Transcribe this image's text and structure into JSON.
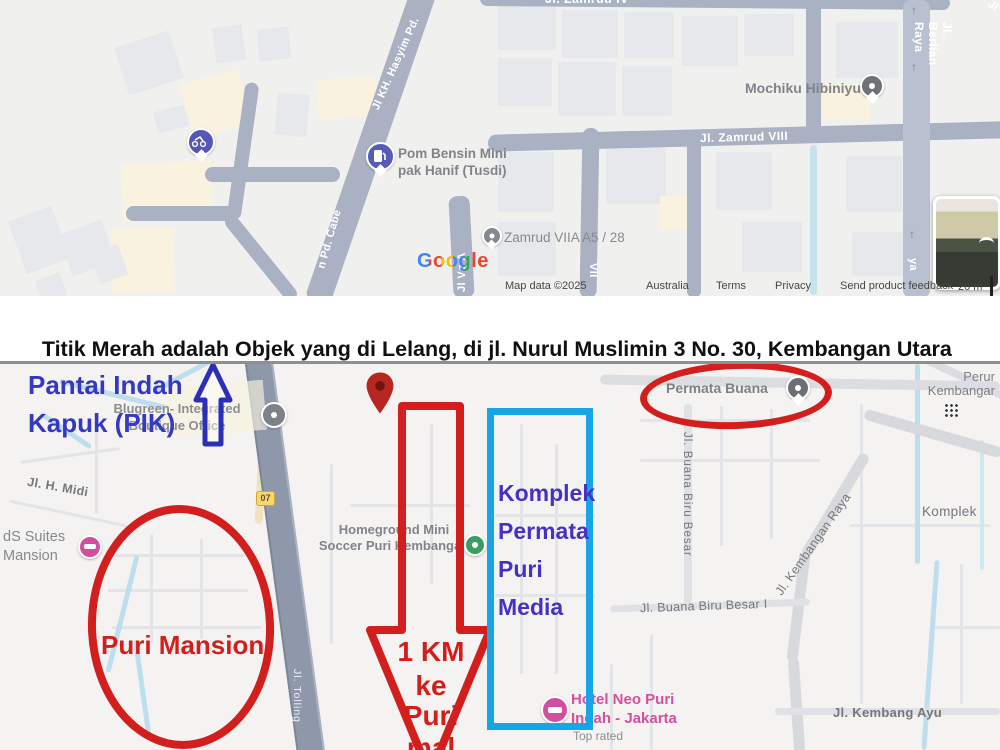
{
  "annotation_title": {
    "part1": "Titik",
    "part2": " Merah ",
    "part3": "adalah Objek",
    "part4": " yang di Lelang, di ",
    "part5": "jl.",
    "part6": " Nurul Muslimin 3 No. 30, Kembangan Utara"
  },
  "top_map": {
    "streets": {
      "hasyim": "Jl KH. Hasyim Pd.",
      "pd_cabe": "n Pd. Cabe",
      "zamrud_viii": "Jl. Zamrud VIII",
      "zamrud_top": "Jl. Zamrud IV",
      "berlian_raya": "Jl. Berlian Raya",
      "vg_a": "Jl Vg A",
      "vii": "VII",
      "ya": "ya",
      "jl_corner": "Jl"
    },
    "pois": {
      "pom_bensin": "Pom Bensin Mini\npak Hanif (Tusdi)",
      "mochiku": "Mochiku Hibiniyu",
      "zamrud_viia": "Zamrud VIIA A5 / 28"
    },
    "google_logo": "Google",
    "attribution": {
      "map_data": "Map data ©2025",
      "region": "Australia",
      "terms": "Terms",
      "privacy": "Privacy",
      "feedback": "Send product feedback",
      "scale_label": "20 m"
    }
  },
  "bottom_map": {
    "annotations": {
      "pik": "Pantai Indah\nKapuk (PIK)",
      "komplek": "Komplek\nPermata\nPuri\nMedia",
      "puri_mansion": "Puri Mansion",
      "arrow_l1": "1 KM",
      "arrow_l2": "ke",
      "arrow_l3": "Puri",
      "arrow_l4": "mal"
    },
    "pois": {
      "blugreen": "Blugreen- Integrated\nBoutique Office",
      "permata_buana": "Permata Buana",
      "homeground": "Homeground Mini\nSoccer Puri Kembangan",
      "hotel_neo": "Hotel Neo Puri\nIndah - Jakarta",
      "hotel_neo_sub": "Top rated",
      "suites": "dS Suites\nMansion",
      "perumahan": "Perur\nKembangar"
    },
    "streets": {
      "h_midi": "Jl. H. Midi",
      "buana_biru": "Jl. Buana Biru Besar",
      "kembangan_raya": "Jl. Kembangan Raya",
      "buana_biru_i": "Jl. Buana Biru Besar I",
      "kembang_ayu": "Jl. Kembang Ayu",
      "komplek_right": "Komplek",
      "toll": "Jl. Tolling",
      "route_shield": "07"
    }
  },
  "colors": {
    "annotation_red": "#d21f1d",
    "annotation_blue_box": "#17a5e5",
    "annotation_navy": "#2b2fb8",
    "pik_text": "#3438c2",
    "komplek_text": "#4531c6",
    "hotel_pink": "#d4509b"
  },
  "icons": [
    "scooter-pin-icon",
    "fuel-pin-icon",
    "poi-pin-icon",
    "red-marker-icon",
    "hotel-pin-icon",
    "soccer-pin-icon",
    "apps-grid-icon",
    "street-view-thumbnail",
    "up-arrow-icon",
    "down-arrow-icon",
    "one-way-arrow-icon",
    "rotate-arrow-icon",
    "route-shield"
  ]
}
